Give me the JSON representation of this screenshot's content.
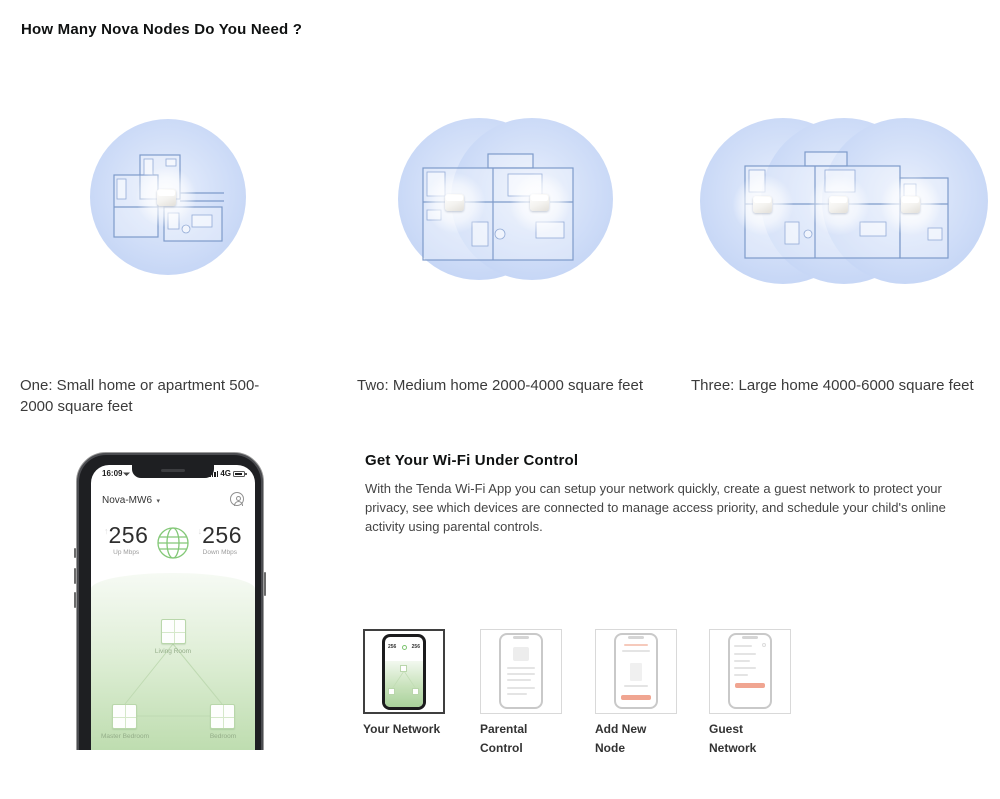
{
  "nodes_section": {
    "title": "How Many Nova Nodes Do You Need ?",
    "options": [
      {
        "caption": "One: Small home or apartment 500-2000 square feet"
      },
      {
        "caption": "Two: Medium home 2000-4000 square feet"
      },
      {
        "caption": "Three: Large home 4000-6000 square feet"
      }
    ]
  },
  "app_section": {
    "title": "Get Your Wi-Fi Under Control",
    "body": "With the Tenda Wi-Fi App you can setup your network quickly, create a guest network to protect your privacy, see which devices are connected to manage access priority, and schedule your child's online activity using parental controls.",
    "thumbnails": [
      {
        "label": "Your Network"
      },
      {
        "label": "Parental Control"
      },
      {
        "label": "Add New Node"
      },
      {
        "label": "Guest Network"
      }
    ]
  },
  "phone": {
    "status_time": "16:09",
    "status_network": "4G",
    "network_name": "Nova-MW6",
    "up_value": "256",
    "up_label": "Up Mbps",
    "down_value": "256",
    "down_label": "Down Mbps",
    "rooms": {
      "top": "Living Room",
      "bottom_left": "Master Bedroom",
      "bottom_right": "Bedroom"
    }
  },
  "colors": {
    "coverage_blue": "#c6d6f6",
    "floorplan_line": "#7e9bca",
    "app_green": "#a7d098",
    "salmon_accent": "#f0a591",
    "selected_border": "#3f3f3f"
  }
}
